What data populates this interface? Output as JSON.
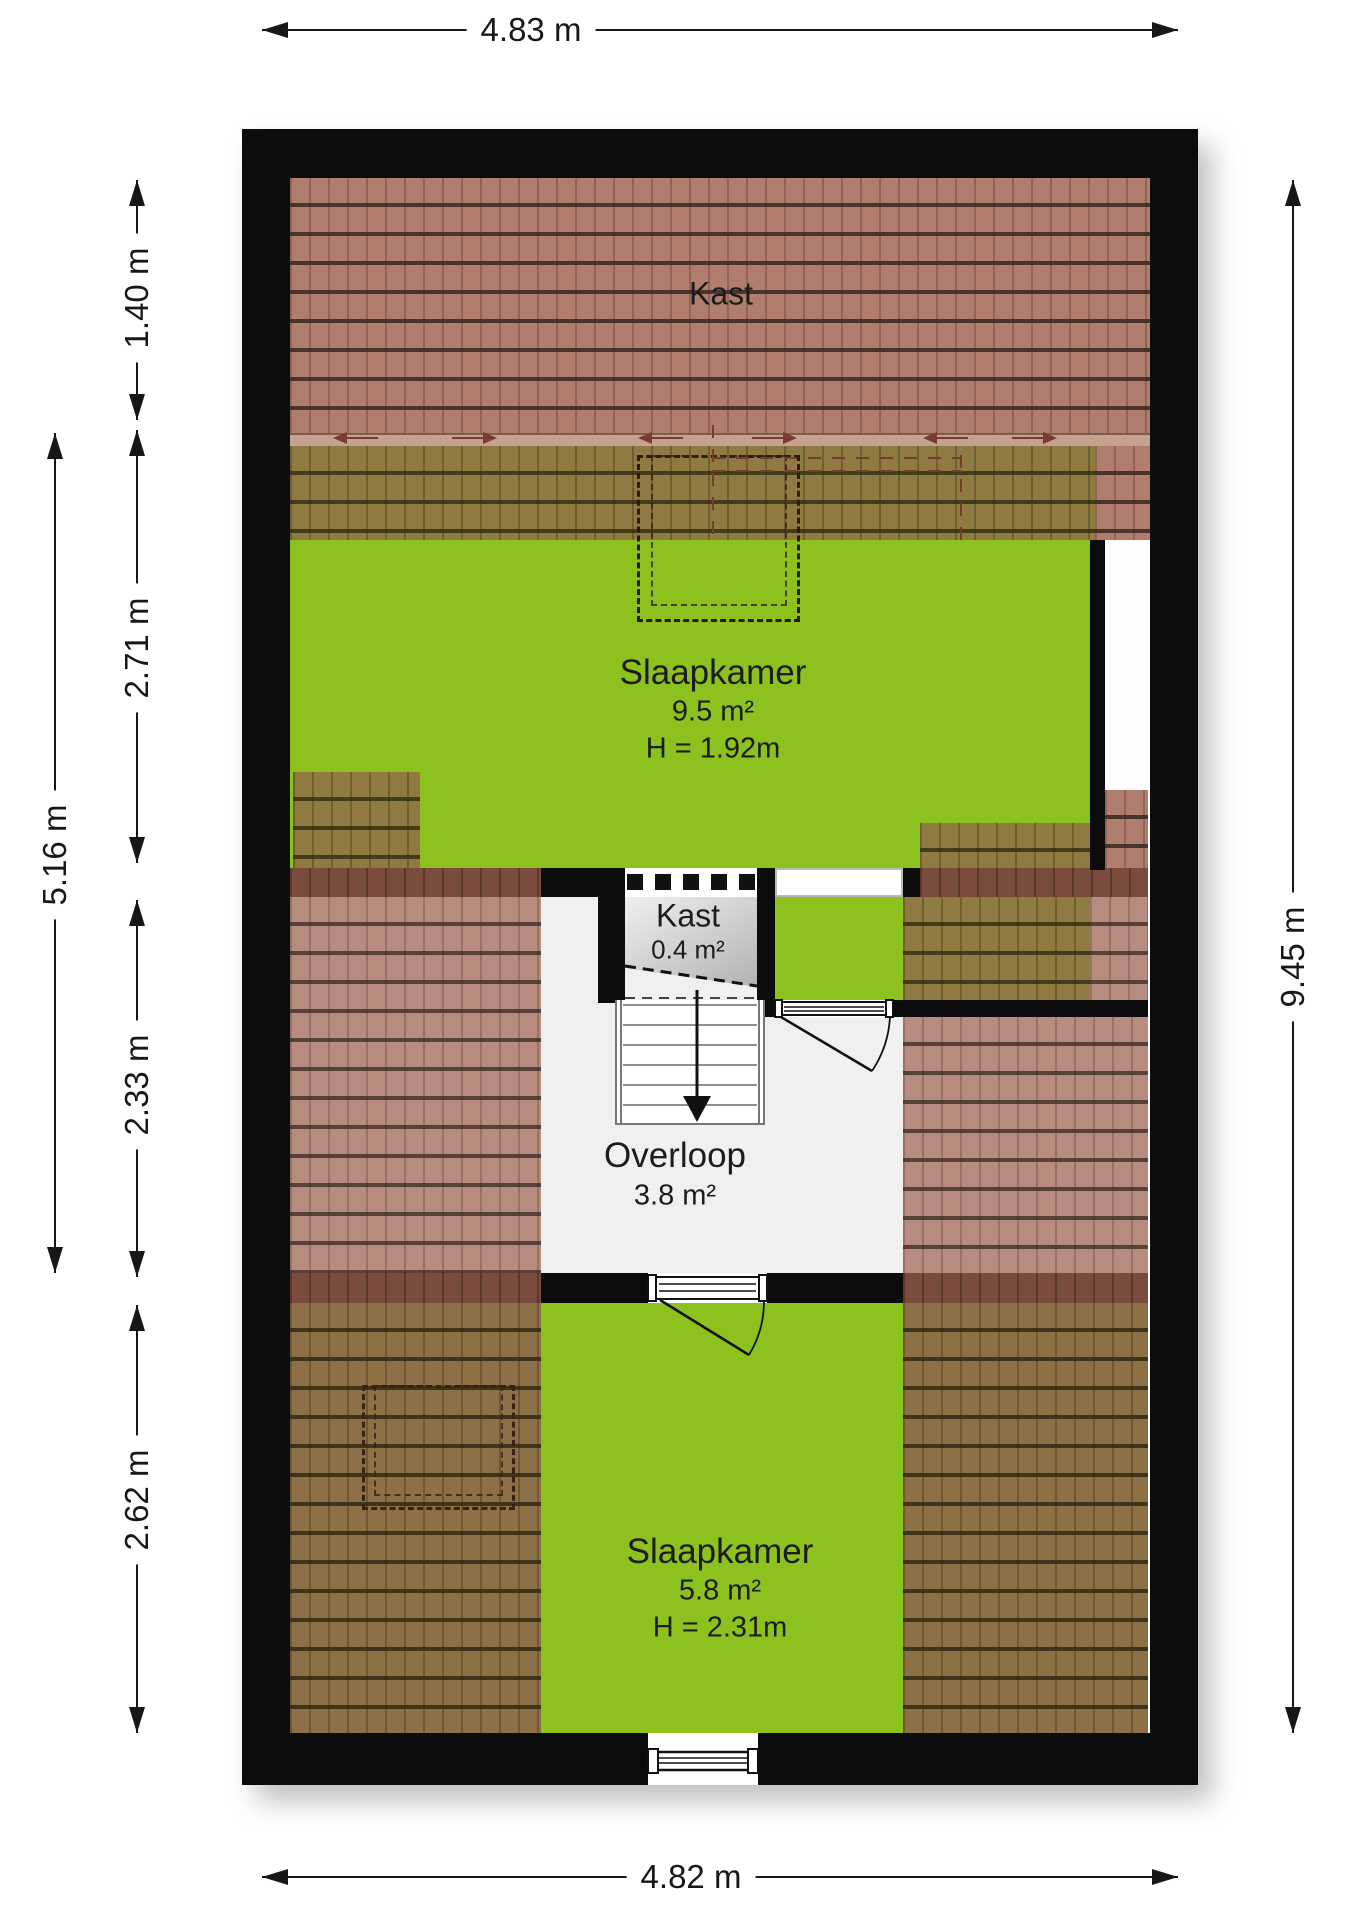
{
  "plan": {
    "rooms": {
      "kast_top": {
        "label": "Kast"
      },
      "slaapkamer_top": {
        "label": "Slaapkamer",
        "area": "9.5 m²",
        "height": "H = 1.92m"
      },
      "kast_mid": {
        "label": "Kast",
        "area": "0.4 m²"
      },
      "overloop": {
        "label": "Overloop",
        "area": "3.8 m²"
      },
      "slaapkamer_bottom": {
        "label": "Slaapkamer",
        "area": "5.8 m²",
        "height": "H = 2.31m"
      }
    },
    "dimensions": {
      "top": "4.83 m",
      "bottom": "4.82 m",
      "right": "9.45 m",
      "left_outer": "5.16 m",
      "left_inner": [
        "1.40 m",
        "2.71 m",
        "2.33 m",
        "2.62 m"
      ]
    },
    "colors": {
      "floor_green": "#8dc21e",
      "roof_salmon": "#b17d6e",
      "roof_pink": "#b78c7f",
      "roof_olive": "#8f7a41",
      "roof_brown": "#8e7047",
      "ridge": "#7b4c3d",
      "wall": "#0c0c0c",
      "closet_gray_top": "#efefef",
      "closet_gray_bottom": "#b2b2b2",
      "overloop_bg": "#f1f0ee",
      "marking_red": "#7a3a2e"
    }
  }
}
